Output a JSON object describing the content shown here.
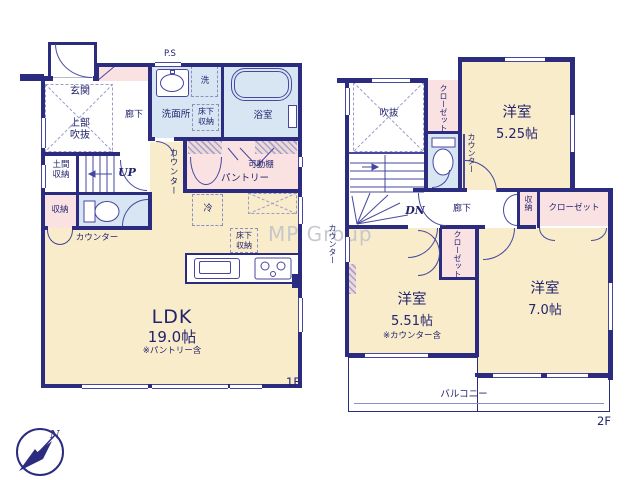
{
  "colors": {
    "wall": "#2b2b80",
    "line": "#4747a0",
    "text": "#23236e",
    "room_cream": "#f8ecca",
    "closet_pink": "#fbe2e2",
    "wet_blue": "#d8e6f3",
    "watermark": "#c0c0cc"
  },
  "watermark": "MP Group",
  "compass": {
    "north": "N"
  },
  "f1": {
    "floor": "1F",
    "ps": "P.S",
    "genkan": "玄関",
    "joubu": "上部\n吹抜",
    "rouka": "廊下",
    "senmenjo": "洗面所",
    "sen": "洗",
    "yukashita_a": "床下\n収納",
    "yokushitsu": "浴室",
    "doma": "土間\n収納",
    "up": "UP",
    "shuno": "収納",
    "counter_h": "カウンター",
    "counter_v": "カウンター",
    "kadoudana": "可動棚",
    "pantry": "パントリー",
    "rei": "冷",
    "yukashita_b": "床下\n収納",
    "ldk": "LDK",
    "ldk_size": "19.0帖",
    "ldk_note": "※パントリー含"
  },
  "f2": {
    "floor": "2F",
    "fukinuke": "吹抜",
    "closet_a": "クローゼット",
    "room1": "洋室",
    "room1_size": "5.25帖",
    "counter_a": "カウンター",
    "dn": "DN",
    "rouka": "廊下",
    "shuno": "収納",
    "closet_b": "クローゼット",
    "closet_c": "クローゼット",
    "counter_b": "カウンター",
    "room2": "洋室",
    "room2_size": "5.51帖",
    "room2_note": "※カウンター含",
    "room3": "洋室",
    "room3_size": "7.0帖",
    "balcony": "バルコニー"
  }
}
